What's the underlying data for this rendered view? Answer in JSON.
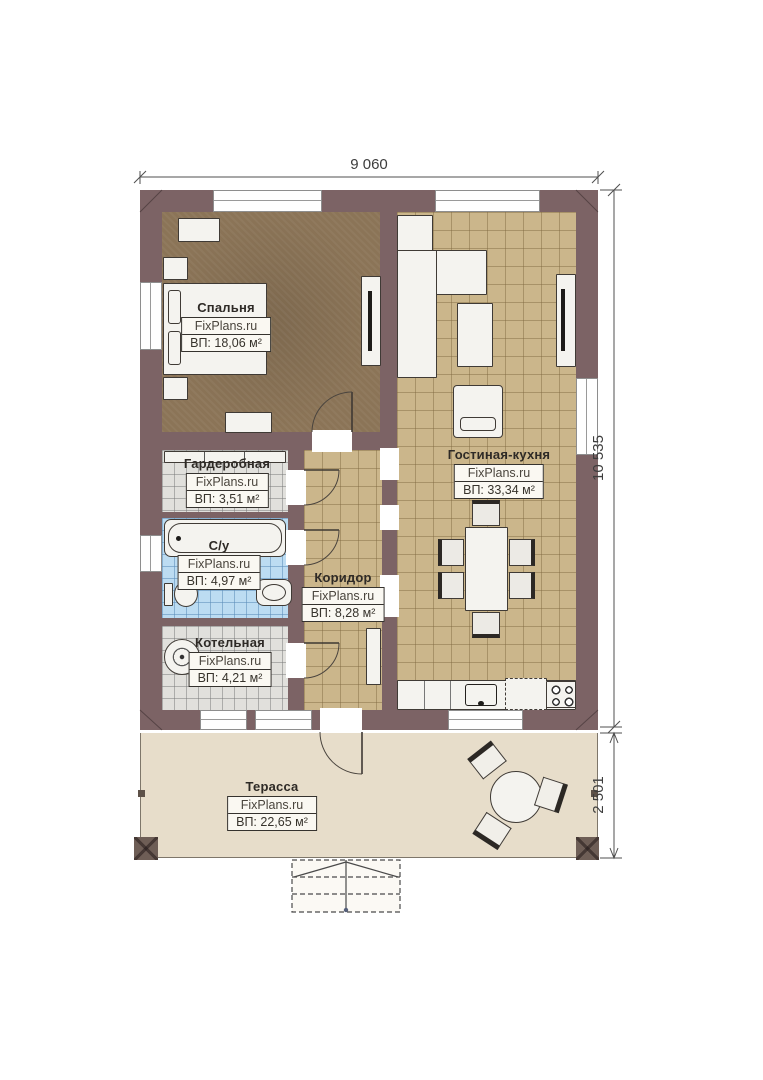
{
  "plan": {
    "brand": "FixPlans.ru",
    "dimensions": {
      "width_top": "9 060",
      "height_right": "10 535",
      "terrace_depth": "2 501"
    },
    "rooms": {
      "bedroom": {
        "name": "Спальня",
        "brand": "FixPlans.ru",
        "area": "ВП: 18,06 м²"
      },
      "wardrobe": {
        "name": "Гардеробная",
        "brand": "FixPlans.ru",
        "area": "ВП: 3,51 м²"
      },
      "bathroom": {
        "name": "С/у",
        "brand": "FixPlans.ru",
        "area": "ВП: 4,97 м²"
      },
      "boiler": {
        "name": "Котельная",
        "brand": "FixPlans.ru",
        "area": "ВП: 4,21 м²"
      },
      "corridor": {
        "name": "Коридор",
        "brand": "FixPlans.ru",
        "area": "ВП: 8,28 м²"
      },
      "living": {
        "name": "Гостиная-кухня",
        "brand": "FixPlans.ru",
        "area": "ВП: 33,34 м²"
      },
      "terrace": {
        "name": "Терасса",
        "brand": "FixPlans.ru",
        "area": "ВП: 22,65 м²"
      }
    },
    "colors": {
      "wall": "#7c6365",
      "bedroom_floor": "#8b7457",
      "tile_floor": "#cbb68b",
      "gray_tile": "#e1e0dc",
      "blue_tile": "#bcdcf2",
      "terrace_floor": "#e7ddca",
      "dimension_text": "#3d3d3d"
    }
  }
}
